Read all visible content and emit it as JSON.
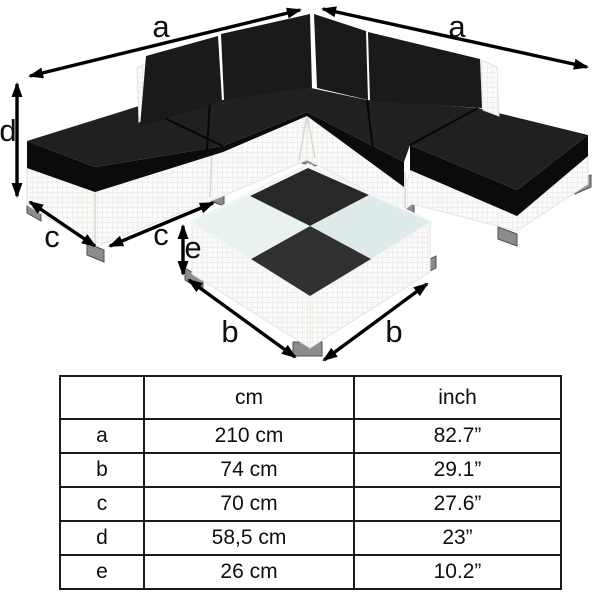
{
  "diagram": {
    "labels": {
      "a": "a",
      "b": "b",
      "c": "c",
      "d": "d",
      "e": "e"
    },
    "description": "Corner rattan lounge set with black cushions, two ottomans and checkered coffee table, annotated with dimension arrows"
  },
  "table": {
    "col_headers": {
      "dimension": "",
      "metric": "cm",
      "imperial": "inch"
    },
    "rows": [
      {
        "label": "a",
        "cm": "210 cm",
        "inch": "82.7”"
      },
      {
        "label": "b",
        "cm": "74 cm",
        "inch": "29.1”"
      },
      {
        "label": "c",
        "cm": "70 cm",
        "inch": "27.6”"
      },
      {
        "label": "d",
        "cm": "58,5 cm",
        "inch": "23”"
      },
      {
        "label": "e",
        "cm": "26 cm",
        "inch": "10.2”"
      }
    ]
  },
  "colors": {
    "bg": "#ffffff",
    "ink": "#0f0f0f",
    "cushion_top": "#202020",
    "cushion_front": "#0b0b0b",
    "back_cushion": "#1a1a1a",
    "base": "#fbfbf9",
    "base_line": "#d9d9d6",
    "checker_dark": "#282828",
    "checker_dark2": "#313131",
    "checker_light": "#e9f1f1",
    "checker_light2": "#dfeaea",
    "glass_rim": "#f2f6f6",
    "foot": "#8c8c8c",
    "foot_dark": "#4f4f4f",
    "table_border": "#1a1a1a"
  }
}
